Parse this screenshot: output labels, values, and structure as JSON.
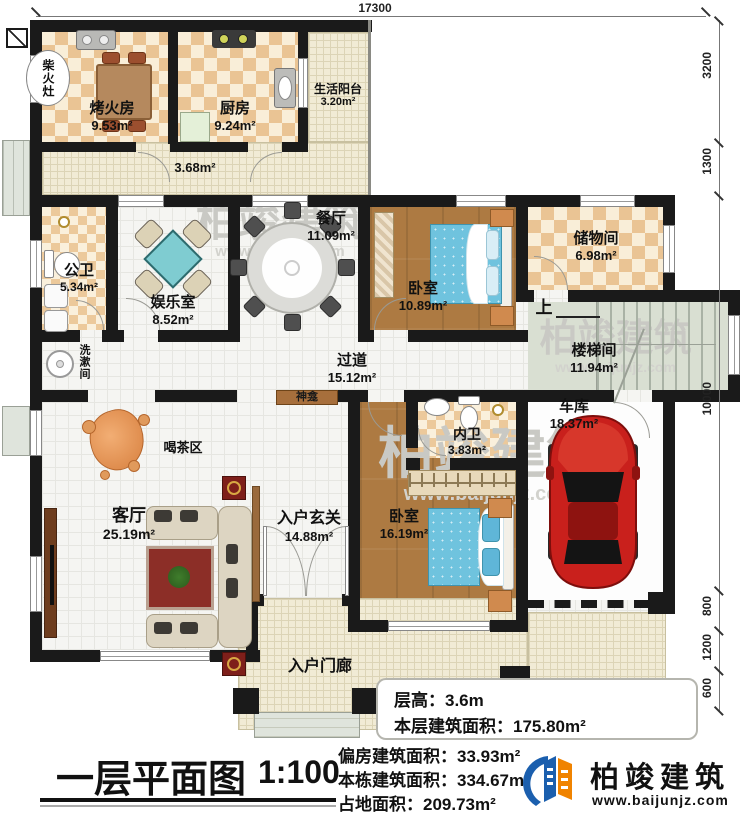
{
  "dims": {
    "top": "17300",
    "right": [
      "3200",
      "1300",
      "10000",
      "800",
      "1200",
      "600"
    ]
  },
  "rooms": {
    "chaihuozao": {
      "name": "柴火灶"
    },
    "kaohuofang": {
      "name": "烤火房",
      "area": "9.53m²"
    },
    "chufang": {
      "name": "厨房",
      "area": "9.24m²"
    },
    "yangtai": {
      "name": "生活阳台",
      "area": "3.20m²"
    },
    "pianfang_corridor": {
      "area": "3.68m²"
    },
    "gongwei": {
      "name": "公卫",
      "area": "5.34m²"
    },
    "yuleshi": {
      "name": "娱乐室",
      "area": "8.52m²"
    },
    "canting": {
      "name": "餐厅",
      "area": "11.09m²"
    },
    "woshi1": {
      "name": "卧室",
      "area": "10.89m²"
    },
    "chuwujian": {
      "name": "储物间",
      "area": "6.98m²"
    },
    "loutijian": {
      "name": "楼梯间",
      "area": "11.94m²",
      "up": "上"
    },
    "guodao": {
      "name": "过道",
      "area": "15.12m²"
    },
    "xishujian": {
      "name": "洗漱间"
    },
    "shenkan": {
      "name": "神龛"
    },
    "hechaqu": {
      "name": "喝茶区"
    },
    "keting": {
      "name": "客厅",
      "area": "25.19m²"
    },
    "xuanguan": {
      "name": "入户玄关",
      "area": "14.88m²"
    },
    "neiwei": {
      "name": "内卫",
      "area": "3.83m²"
    },
    "woshi2": {
      "name": "卧室",
      "area": "16.19m²"
    },
    "cheku": {
      "name": "车库",
      "area": "18.37m²"
    },
    "menlang": {
      "name": "入户门廊"
    }
  },
  "stats": [
    {
      "label": "层高：",
      "value": "3.6m"
    },
    {
      "label": "本层建筑面积：",
      "value": "175.80m²"
    },
    {
      "label": "偏房建筑面积：",
      "value": "33.93m²"
    },
    {
      "label": "本栋建筑面积：",
      "value": "334.67m²"
    },
    {
      "label": "占地面积：",
      "value": "209.73m²"
    }
  ],
  "title": {
    "text": "一层平面图",
    "scale": "1:100"
  },
  "logo": {
    "name": "柏竣建筑",
    "url": "www.baijunjz.com"
  },
  "watermark": {
    "text": "柏竣建筑",
    "url": "www.baijunjz.com"
  },
  "colors": {
    "wall": "#1a1a1a",
    "accent_blue": "#1b5fae",
    "accent_orange": "#f08300",
    "bed": "#6fc3de",
    "car": "#c9201c"
  }
}
